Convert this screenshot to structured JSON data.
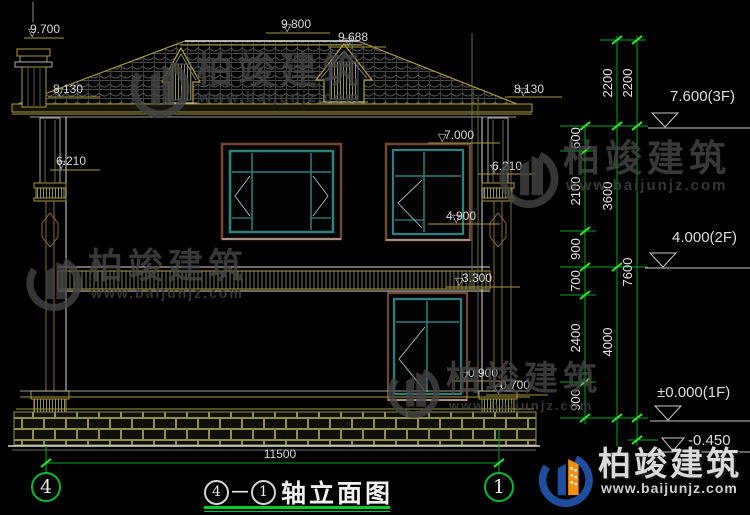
{
  "drawing": {
    "facade_levels": {
      "chimney_top": "9.700",
      "ridge": "9.800",
      "dormer_top": "9.688",
      "eave_left": "8.130",
      "eave_right": "8.130",
      "window2f_head": "7.000",
      "capital_left": "6.210",
      "capital_right": "6.210",
      "window2f_sill": "4.900",
      "window1f_head": "3.300",
      "window1f_sill": "0.900",
      "plinth_top": "0.700"
    },
    "floor_levels": {
      "third": "7.600(3F)",
      "second": "4.000(2F)",
      "first": "±0.000(1F)",
      "ground": "-0.450"
    },
    "dim_inner": [
      "600",
      "2100",
      "900",
      "700",
      "2400",
      "900"
    ],
    "dim_mid": [
      "2200",
      "3600",
      "4000"
    ],
    "dim_outer": [
      "2200",
      "7600"
    ],
    "total_width": "11500",
    "axis_left": "4",
    "axis_right": "1",
    "title": {
      "from": "4",
      "to": "1",
      "text": "轴立面图"
    }
  },
  "watermark": {
    "brand": "柏竣建筑",
    "url": "www.baijunjz.com"
  },
  "icons": {
    "level_triangle": "▽",
    "dash": "—"
  },
  "colors": {
    "dim_green": "#00c000",
    "trim_olive": "#a89a3c",
    "line_white": "#d9d9d9",
    "window_teal": "#2e8080",
    "trim_brown": "#6e4633",
    "logo_blue": "#1e4f9e",
    "logo_orange": "#f29111"
  }
}
